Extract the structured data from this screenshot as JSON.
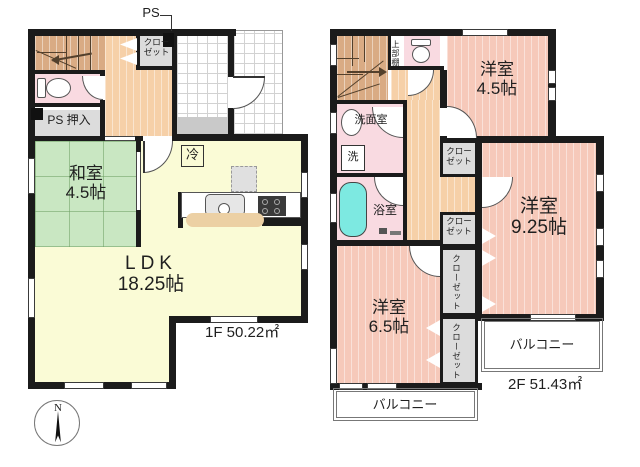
{
  "document_type": "floor-plan",
  "compass": {
    "north_label": "N"
  },
  "floor1": {
    "area_label": "1F 50.22㎡",
    "ps_top_label": "PS",
    "entrance_closet": {
      "line1": "クロー",
      "line2": "ゼット"
    },
    "ps_oshiire_label": "PS 押入",
    "washitsu": {
      "line1": "和室",
      "line2": "4.5帖"
    },
    "ldk": {
      "line1": "LDK",
      "line2": "18.25帖"
    },
    "fridge_label": "冷"
  },
  "floor2": {
    "area_label": "2F 51.43㎡",
    "upper_shelf_label": "上部棚",
    "washroom_label": "洗面室",
    "washer_label": "洗",
    "bathroom_label": "浴室",
    "bedroom_45": {
      "line1": "洋室",
      "line2": "4.5帖"
    },
    "bedroom_925": {
      "line1": "洋室",
      "line2": "9.25帖"
    },
    "bedroom_65": {
      "line1": "洋室",
      "line2": "6.5帖"
    },
    "closet_hall": {
      "line1": "クロー",
      "line2": "ゼット"
    },
    "closet_mid": {
      "line1": "クロー",
      "line2": "ゼット"
    },
    "closet_925": "クローゼット",
    "closet_65": "クローゼット",
    "balcony_south": "バルコニー",
    "balcony_east": "バルコニー"
  },
  "colors": {
    "wall": "#1b1b1b",
    "tatami": "#c9e7c2",
    "ldk": "#fafbd6",
    "bedroom": "#f6c9ba",
    "hall": "#f6d0a8",
    "wet": "#f9dae1",
    "closet": "#dcdcdc",
    "stairs": "#d9ab84",
    "tub": "#7de9e1",
    "step": "#c9c9c9",
    "bar": "#ecd0a4"
  }
}
